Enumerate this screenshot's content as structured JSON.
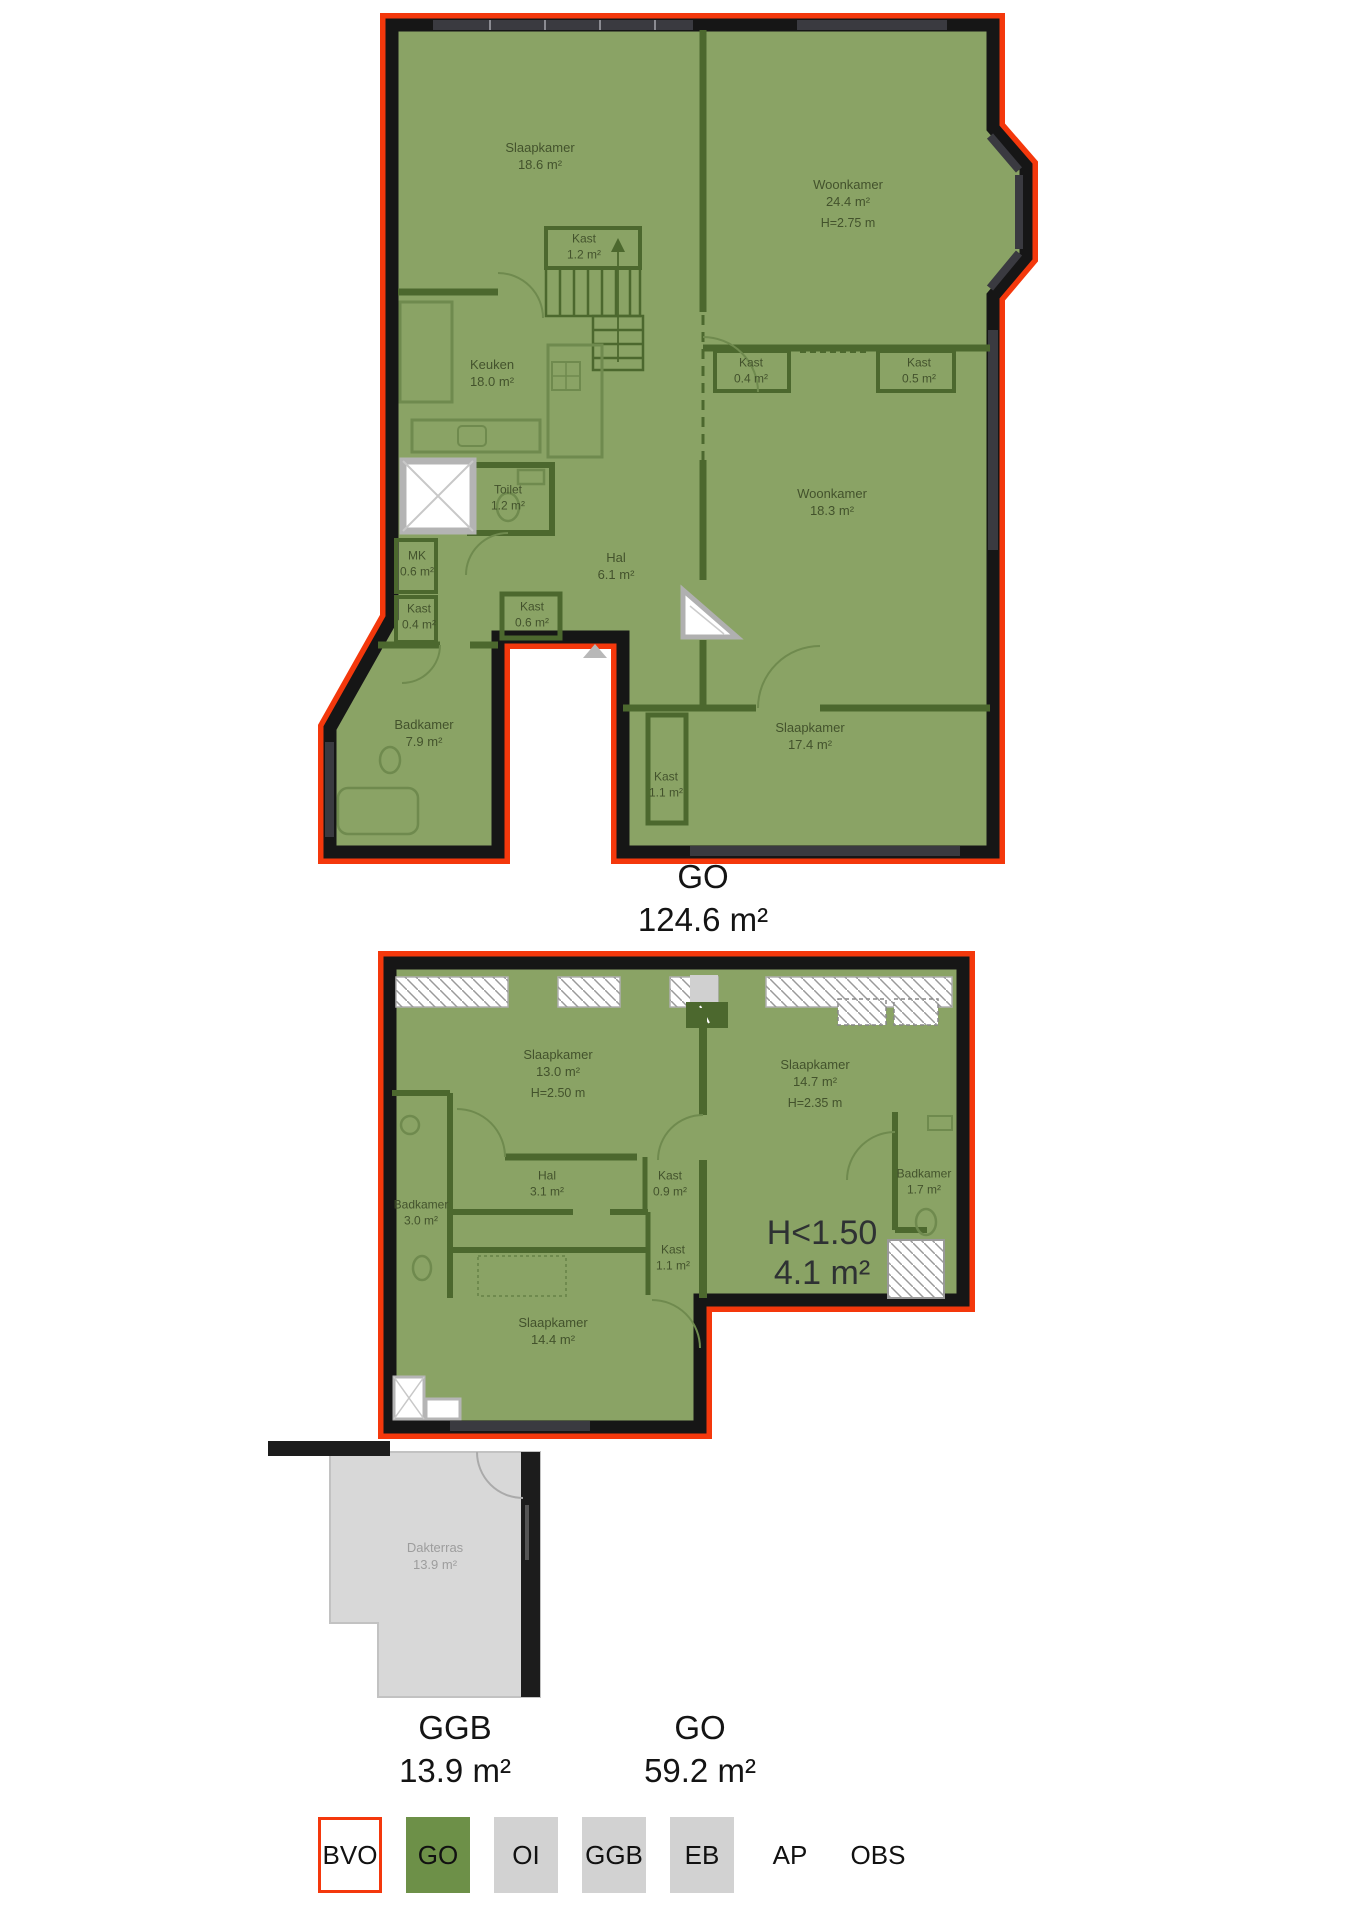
{
  "colors": {
    "outline_red": "#f4380c",
    "go_fill_green": "#8aa365",
    "go_legend_green": "#6d9048",
    "legend_gray": "#d2d2d2",
    "wall_black": "#161616",
    "wall_green": "#4c682e",
    "terrace_gray": "#d8d8d8"
  },
  "plan1": {
    "area_label": {
      "code": "GO",
      "value": "124.6 m²"
    },
    "rooms": [
      {
        "name": "Slaapkamer",
        "area": "18.6 m²"
      },
      {
        "name": "Kast",
        "area": "1.2 m²"
      },
      {
        "name": "Woonkamer",
        "area": "24.4 m²",
        "height": "H=2.75 m"
      },
      {
        "name": "Keuken",
        "area": "18.0 m²"
      },
      {
        "name": "Kast",
        "area": "0.4 m²"
      },
      {
        "name": "Kast",
        "area": "0.5 m²"
      },
      {
        "name": "Toilet",
        "area": "1.2 m²"
      },
      {
        "name": "Woonkamer",
        "area": "18.3 m²"
      },
      {
        "name": "MK",
        "area": "0.6 m²"
      },
      {
        "name": "Hal",
        "area": "6.1 m²"
      },
      {
        "name": "Kast",
        "area": "0.4 m²"
      },
      {
        "name": "Kast",
        "area": "0.6 m²"
      },
      {
        "name": "Badkamer",
        "area": "7.9 m²"
      },
      {
        "name": "Kast",
        "area": "1.1 m²"
      },
      {
        "name": "Slaapkamer",
        "area": "17.4 m²"
      }
    ]
  },
  "plan2": {
    "area_labels": [
      {
        "code": "GGB",
        "value": "13.9 m²"
      },
      {
        "code": "GO",
        "value": "59.2 m²"
      }
    ],
    "annotation": {
      "line1": "H<1.50",
      "line2": "4.1 m²"
    },
    "rooms": [
      {
        "name": "Slaapkamer",
        "area": "13.0 m²",
        "height": "H=2.50 m"
      },
      {
        "name": "Slaapkamer",
        "area": "14.7 m²",
        "height": "H=2.35 m"
      },
      {
        "name": "Hal",
        "area": "3.1 m²"
      },
      {
        "name": "Kast",
        "area": "0.9 m²"
      },
      {
        "name": "Badkamer",
        "area": "3.0 m²"
      },
      {
        "name": "Badkamer",
        "area": "1.7 m²"
      },
      {
        "name": "Kast",
        "area": "1.1 m²"
      },
      {
        "name": "Slaapkamer",
        "area": "14.4 m²"
      },
      {
        "name": "Dakterras",
        "area": "13.9 m²"
      }
    ]
  },
  "legend": {
    "items": [
      {
        "label": "BVO"
      },
      {
        "label": "GO"
      },
      {
        "label": "OI"
      },
      {
        "label": "GGB"
      },
      {
        "label": "EB"
      },
      {
        "label": "AP"
      },
      {
        "label": "OBS"
      }
    ]
  }
}
